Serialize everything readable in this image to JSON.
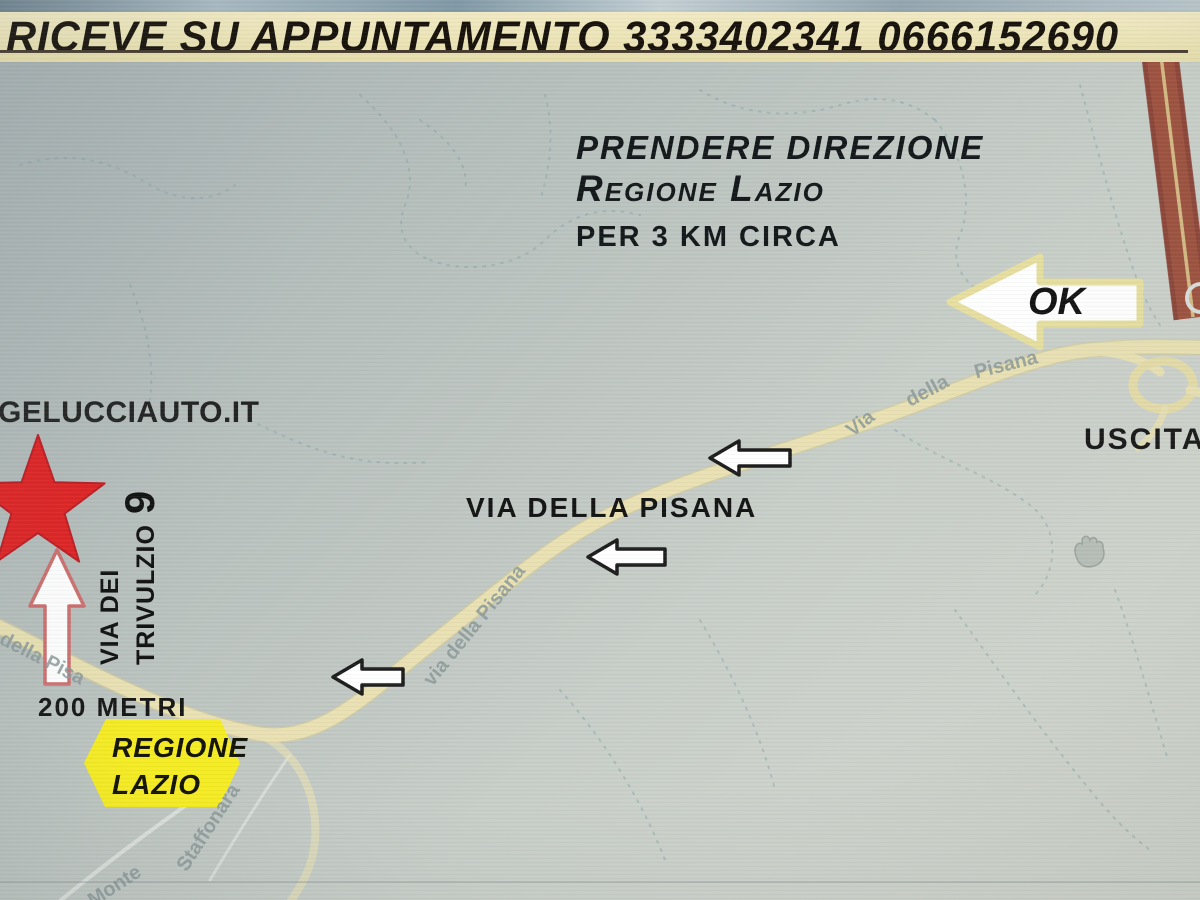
{
  "banner": {
    "text": "RICEVE SU APPUNTAMENTO 3333402341  0666152690"
  },
  "directions": {
    "line1": "PRENDERE DIREZIONE",
    "line2": "Regione Lazio",
    "line3": "PER 3 KM CIRCA"
  },
  "ok_label": "OK",
  "website": "GELUCCIAUTO.IT",
  "street": {
    "line1": "VIA DEI",
    "line2": "TRIVULZIO",
    "number": "9"
  },
  "distance": "200 METRI",
  "badge": {
    "line1": "REGIONE",
    "line2": "LAZIO"
  },
  "road_label": "VIA DELLA PISANA",
  "exit_label": "USCITA",
  "map_labels": {
    "bottom_left": "della Pisa",
    "middle": "via della Pisana",
    "upper_1": "Via",
    "upper_2": "della",
    "upper_3": "Pisana",
    "side_road": "Staffonara",
    "bottom": "Monte"
  },
  "colors": {
    "banner_bg": "#ece4b6",
    "map_road": "#e9e1b2",
    "highway": "#9e4f3c",
    "star": "#e32121",
    "badge_bg": "#f6ec20",
    "ok_border": "#e7df9e"
  }
}
